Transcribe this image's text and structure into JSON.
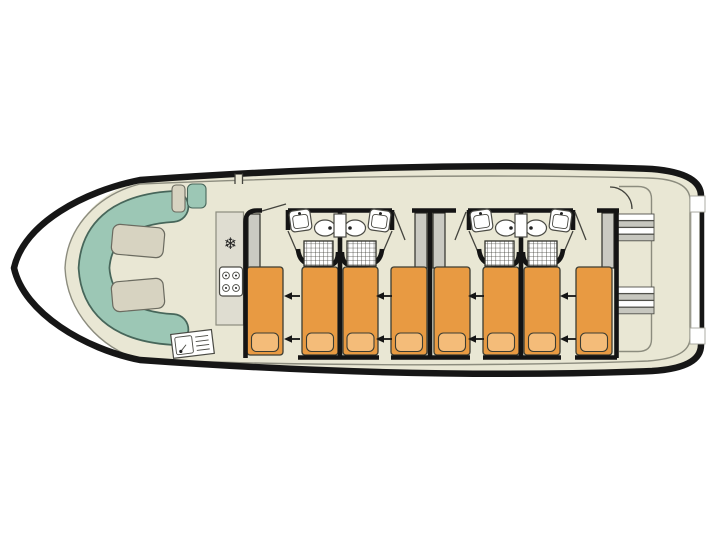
{
  "meta": {
    "type": "boat-deck-floor-plan",
    "description": "Top-down deck plan of a canal cruiser: bow saloon with U-sofa and tables, galley, side corridor, four double cabins each with sliding twin beds, wardrobe and en-suite bathroom (washbasin, toilet, shower), aft deck with twin staircases"
  },
  "colors": {
    "hull": "#161616",
    "deck": "#e9e7d4",
    "wall": "#141414",
    "line": "#8c8c7e",
    "upholstery": "#9cc7b5",
    "upholstery-border": "#47665a",
    "cushion": "#d7d3c1",
    "cushion-border": "#6b6b60",
    "bed": "#e89a42",
    "pillow": "#f4bc79",
    "wardrobe": "#cacac2",
    "counter": "#dfddd1",
    "fixture": "#ffffff",
    "fixture-stroke": "#4a4a44",
    "step": "#c7c7bf"
  },
  "icons": {
    "freezer_glyph": "❄",
    "freezer": "snowflake-freezer",
    "stove": "four-burner-hob",
    "galley_sink": "sink-with-drainer",
    "washbasin": "washbasin",
    "toilet": "toilet",
    "shower": "shower-tray-grid",
    "stairs": "staircase-steps",
    "slide_arrow": "beds-slide-together-arrow"
  },
  "areas": {
    "bow_saloon": {
      "sofa": "U-shaped sofa",
      "tables": 2,
      "helm_seat": 1,
      "helm_step": 1
    },
    "galley": {
      "equipment": [
        "freezer",
        "4-burner stove",
        "sink with drainer"
      ]
    },
    "corridor": {
      "side": "top (port) side, saloon to aft deck"
    },
    "cabins": [
      {
        "beds": 2,
        "wardrobe": 1,
        "bathroom": {
          "washbasin": 1,
          "toilet": 1,
          "shower": 1
        }
      },
      {
        "beds": 2,
        "wardrobe": 1,
        "bathroom": {
          "washbasin": 1,
          "toilet": 1,
          "shower": 1
        }
      },
      {
        "beds": 2,
        "wardrobe": 1,
        "bathroom": {
          "washbasin": 1,
          "toilet": 1,
          "shower": 1
        }
      },
      {
        "beds": 2,
        "wardrobe": 1,
        "bathroom": {
          "washbasin": 1,
          "toilet": 1,
          "shower": 1
        }
      }
    ],
    "aft_deck": {
      "staircases": 2,
      "boarding_gates": 2
    }
  },
  "totals": {
    "cabins": 4,
    "single_beds": 8,
    "bathrooms": 4,
    "slide_arrows": 8
  }
}
